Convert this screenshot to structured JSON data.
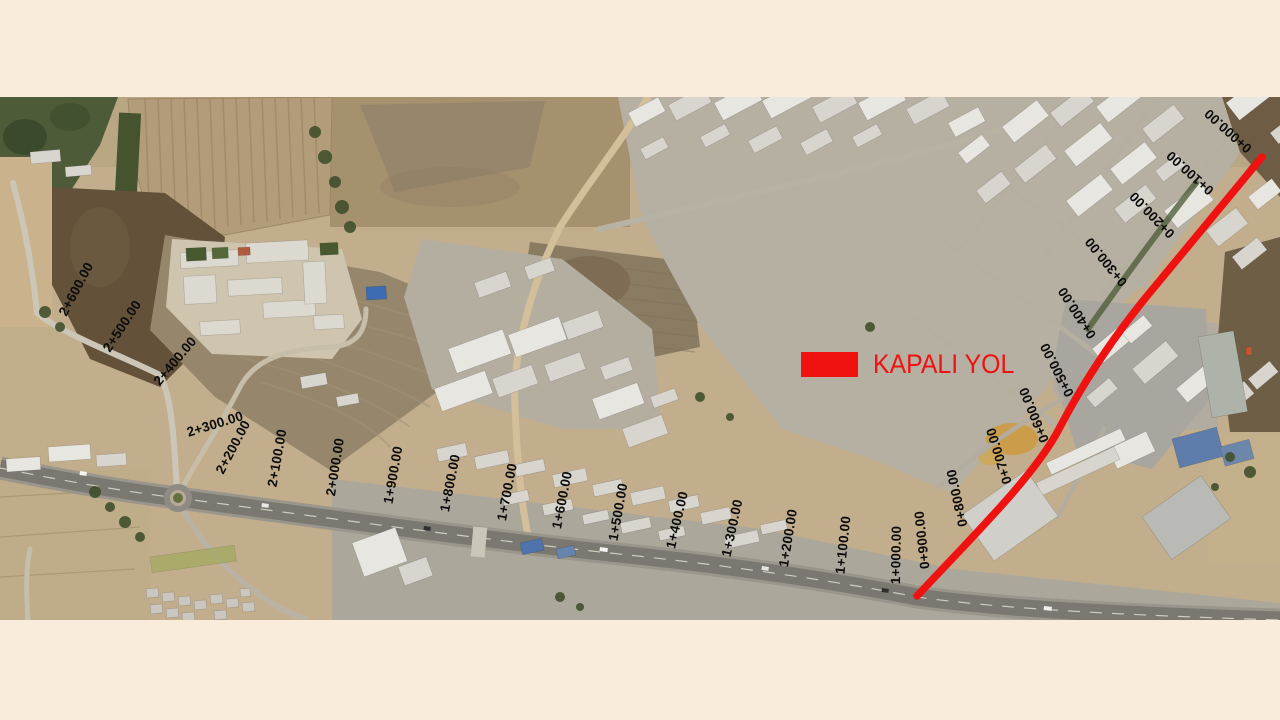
{
  "page": {
    "background_color": "#f9ecda",
    "description": "Satellite map with road chainage annotations"
  },
  "map": {
    "legend": {
      "label": "KAPALI YOL",
      "swatch_color": "#f01111",
      "text_color": "#f01111"
    },
    "route": {
      "name": "closed-road",
      "color": "#f01111",
      "stroke_width": 7.5,
      "path": "M 1262 60 L 1152 193 C 1112 241 1083 286 1059 332 C 1035 378 975 437 917 499"
    },
    "chainage_labels": [
      {
        "text": "0+000.00",
        "x": 1228,
        "y": 34,
        "rot": -138
      },
      {
        "text": "0+100.00",
        "x": 1190,
        "y": 76,
        "rot": -138
      },
      {
        "text": "0+200.00",
        "x": 1152,
        "y": 118,
        "rot": -134
      },
      {
        "text": "0+300.00",
        "x": 1106,
        "y": 165,
        "rot": -129
      },
      {
        "text": "0+400.00",
        "x": 1077,
        "y": 216,
        "rot": -123
      },
      {
        "text": "0+500.00",
        "x": 1057,
        "y": 273,
        "rot": -117
      },
      {
        "text": "0+600.00",
        "x": 1034,
        "y": 318,
        "rot": -112
      },
      {
        "text": "0+700.00",
        "x": 999,
        "y": 359,
        "rot": -107
      },
      {
        "text": "0+800.00",
        "x": 957,
        "y": 401,
        "rot": -102
      },
      {
        "text": "0+900.00",
        "x": 922,
        "y": 443,
        "rot": -96
      },
      {
        "text": "1+000.00",
        "x": 896,
        "y": 458,
        "rot": -89
      },
      {
        "text": "1+100.00",
        "x": 843,
        "y": 448,
        "rot": -84
      },
      {
        "text": "1+200.00",
        "x": 788,
        "y": 441,
        "rot": -81
      },
      {
        "text": "1+300.00",
        "x": 732,
        "y": 431,
        "rot": -78
      },
      {
        "text": "1+400.00",
        "x": 677,
        "y": 423,
        "rot": -77
      },
      {
        "text": "1+500.00",
        "x": 618,
        "y": 415,
        "rot": -80
      },
      {
        "text": "1+600.00",
        "x": 562,
        "y": 403,
        "rot": -79
      },
      {
        "text": "1+700.00",
        "x": 507,
        "y": 395,
        "rot": -79
      },
      {
        "text": "1+800.00",
        "x": 450,
        "y": 386,
        "rot": -79
      },
      {
        "text": "1+900.00",
        "x": 393,
        "y": 378,
        "rot": -80
      },
      {
        "text": "2+000.00",
        "x": 335,
        "y": 370,
        "rot": -81
      },
      {
        "text": "2+100.00",
        "x": 277,
        "y": 361,
        "rot": -80
      },
      {
        "text": "2+200.00",
        "x": 233,
        "y": 350,
        "rot": -62
      },
      {
        "text": "2+300.00",
        "x": 215,
        "y": 327,
        "rot": -17
      },
      {
        "text": "2+400.00",
        "x": 175,
        "y": 264,
        "rot": -50
      },
      {
        "text": "2+500.00",
        "x": 122,
        "y": 229,
        "rot": -57
      },
      {
        "text": "2+600.00",
        "x": 76,
        "y": 192,
        "rot": -62
      }
    ]
  }
}
